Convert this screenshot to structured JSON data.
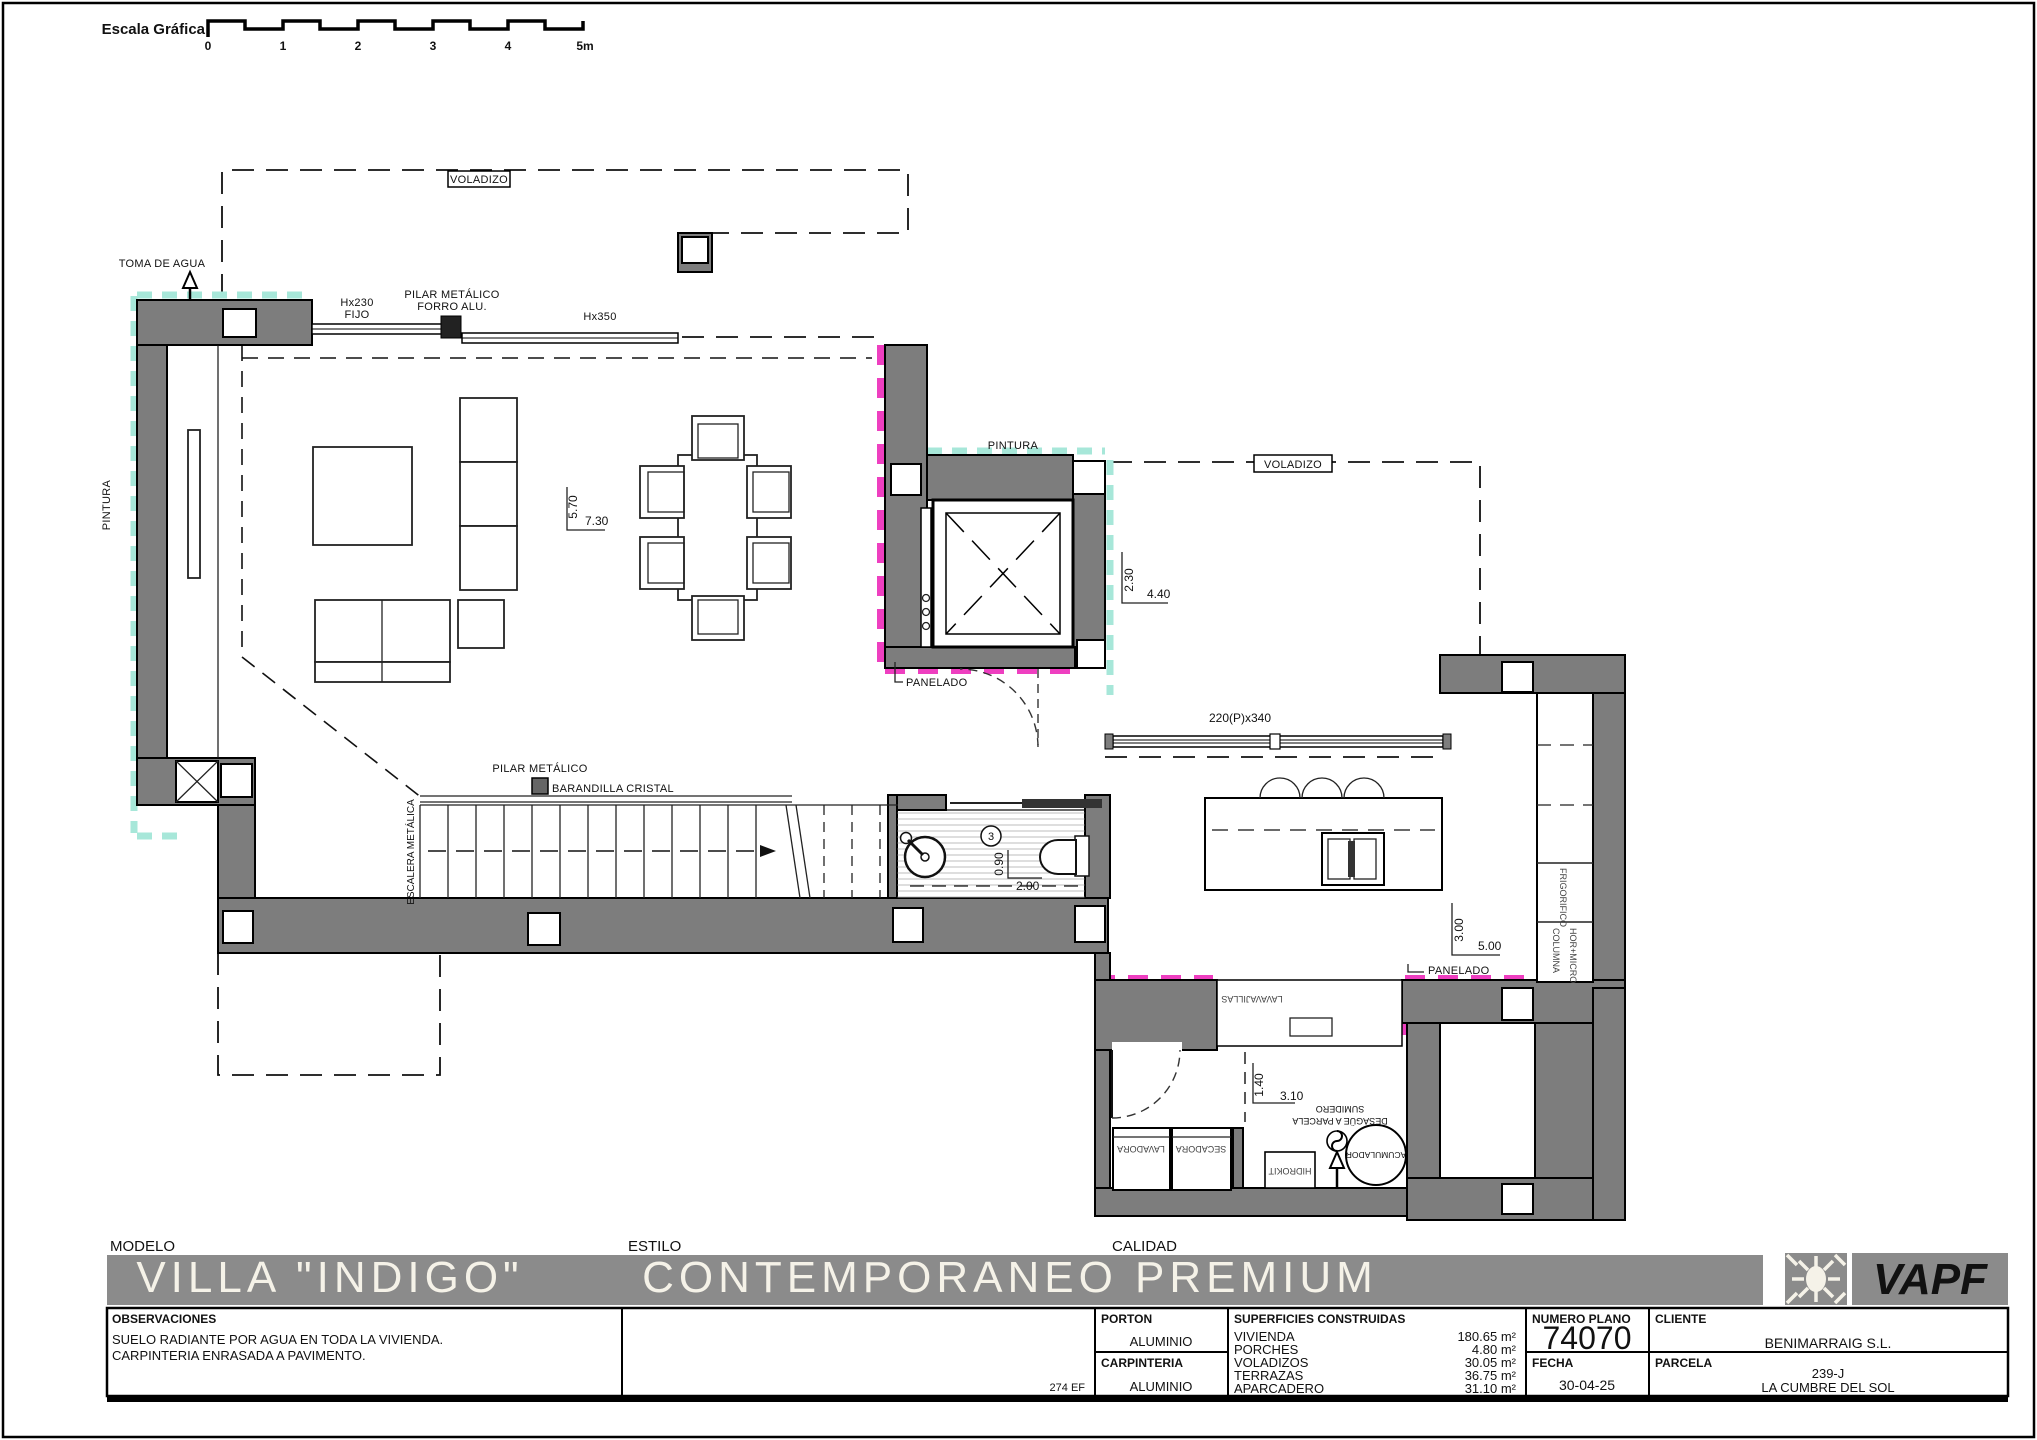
{
  "colors": {
    "wall_gray": "#7d7d7d",
    "banner_gray": "#8b8b8b",
    "panelado_magenta": "#ee3fc0",
    "pintura_teal": "#a7e7d9",
    "title_text": "#f5f2e8"
  },
  "scale_bar": {
    "label": "Escala Gráfica",
    "ticks": [
      "0",
      "1",
      "2",
      "3",
      "4",
      "5m"
    ]
  },
  "plan": {
    "toma_de_agua": "TOMA DE AGUA",
    "voladizo_top": "VOLADIZO",
    "voladizo_right": "VOLADIZO",
    "pintura_left": "PINTURA",
    "pintura_center": "PINTURA",
    "panelado_center": "PANELADO",
    "panelado_kitchen": "PANELADO",
    "window_fixed_line1": "Hx230",
    "window_fixed_line2": "FIJO",
    "pilar_forro_line1": "PILAR METÁLICO",
    "pilar_forro_line2": "FORRO ALU.",
    "window_h350": "Hx350",
    "window_sliding": "220(P)x340",
    "pilar_metalico": "PILAR METÁLICO",
    "barandilla": "BARANDILLA CRISTAL",
    "escalera": "ESCALERA METÁLICA",
    "bath_number": "3",
    "frigorifico": "FRIGORIFICO",
    "columna": "COLUMNA",
    "hor_micro": "HOR+MICRO",
    "lavavajillas": "LAVAVAJILLAS",
    "lavadora": "LAVADORA",
    "secadora": "SECADORA",
    "hidrokit": "HIDROKIT",
    "acumulador": "ACUMULADOR",
    "sumidero_line1": "SUMIDERO",
    "sumidero_line2": "DESAGÜE A PARCELA",
    "dims": {
      "living_v": "5.70",
      "living_h": "7.30",
      "terrace_v": "2.30",
      "terrace_h": "4.40",
      "kitchen_v": "3.00",
      "kitchen_h": "5.00",
      "bath_v": "0.90",
      "bath_h": "2.00",
      "utility_v": "1.40",
      "utility_h": "3.10"
    }
  },
  "title_block": {
    "modelo_label": "MODELO",
    "modelo": "VILLA \"INDIGO\"",
    "estilo_label": "ESTILO",
    "estilo": "CONTEMPORANEO  PREMIUM",
    "calidad_label": "CALIDAD",
    "brand": "VAPF",
    "observaciones_label": "OBSERVACIONES",
    "observaciones_line1": "SUELO RADIANTE POR AGUA EN TODA LA VIVIENDA.",
    "observaciones_line2": "CARPINTERIA ENRASADA A PAVIMENTO.",
    "ref": "274 EF",
    "porton_label": "PORTON",
    "porton": "ALUMINIO",
    "carpinteria_label": "CARPINTERIA",
    "carpinteria": "ALUMINIO",
    "superficies_label": "SUPERFICIES CONSTRUIDAS",
    "superficies": [
      {
        "name": "VIVIENDA",
        "value": "180.65 m²"
      },
      {
        "name": "PORCHES",
        "value": "4.80 m²"
      },
      {
        "name": "VOLADIZOS",
        "value": "30.05 m²"
      },
      {
        "name": "TERRAZAS",
        "value": "36.75 m²"
      },
      {
        "name": "APARCADERO",
        "value": "31.10 m²"
      }
    ],
    "numero_plano_label": "NUMERO PLANO",
    "numero_plano": "74070",
    "fecha_label": "FECHA",
    "fecha": "30-04-25",
    "cliente_label": "CLIENTE",
    "cliente": "BENIMARRAIG S.L.",
    "parcela_label": "PARCELA",
    "parcela_line1": "239-J",
    "parcela_line2": "LA CUMBRE DEL SOL"
  }
}
